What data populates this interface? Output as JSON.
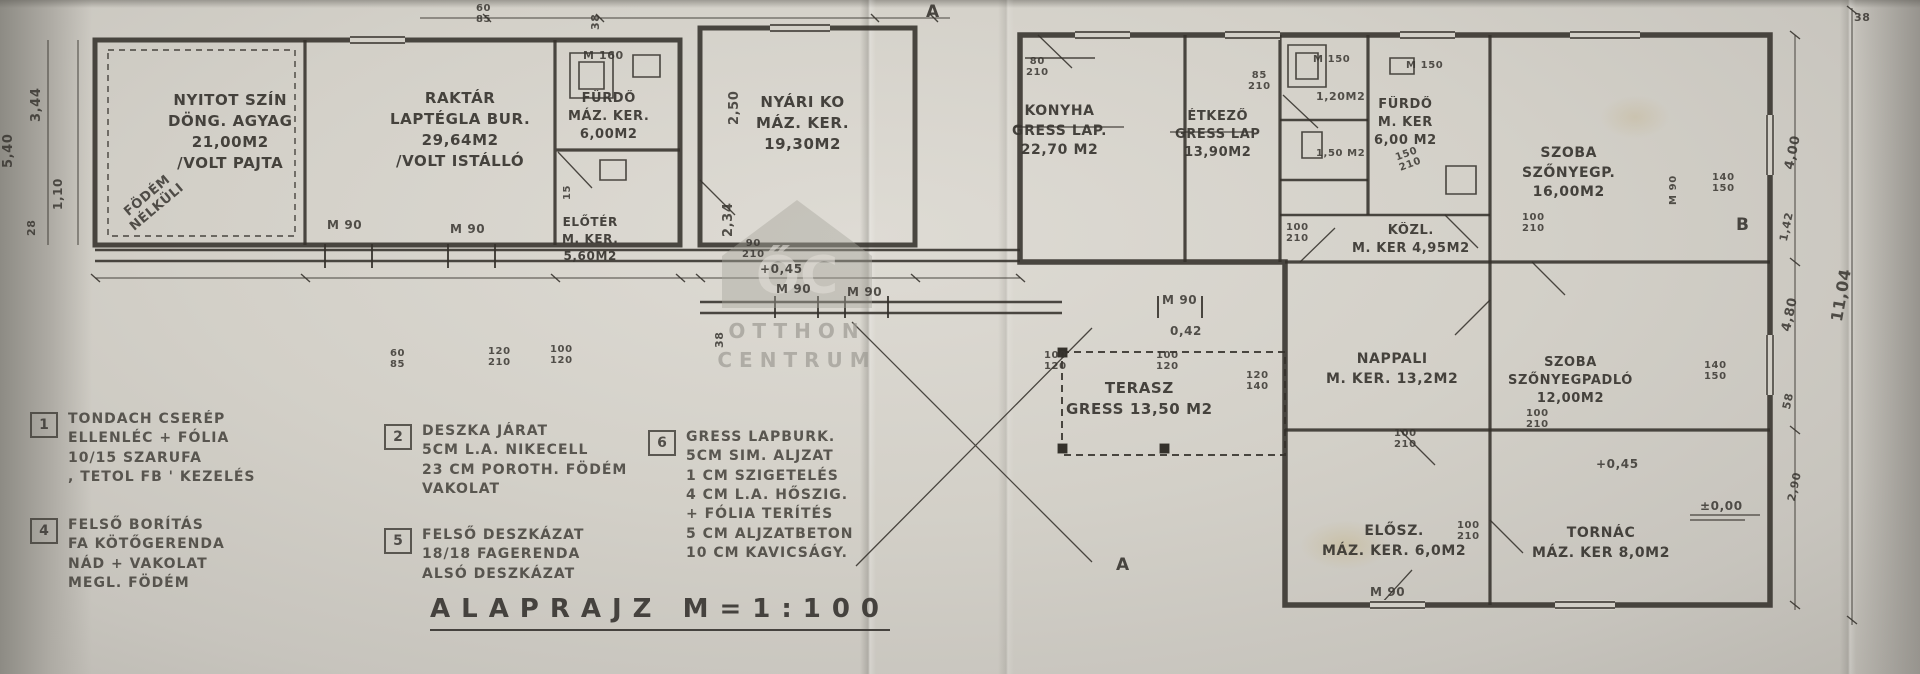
{
  "title": {
    "text": "ALAPRAJZ  M=1:100"
  },
  "watermark": {
    "monogram": "ŐC",
    "name_top": "OTTHON",
    "name_bottom": "CENTRUM"
  },
  "colors": {
    "ink": "#3a3733",
    "paper": "#d3d0c8"
  },
  "plan": {
    "rooms": [
      {
        "text": "NYITOT SZÍN\nDÖNG. AGYAG\n21,00M2\n/VOLT PAJTA",
        "x": 168,
        "y": 90,
        "fs": 15
      },
      {
        "text": "RAKTÁR\nLAPTÉGLA BUR.\n29,64M2\n/VOLT ISTÁLLÓ",
        "x": 390,
        "y": 88,
        "fs": 15
      },
      {
        "text": "FÜRDŐ\nMÁZ. KER.\n6,00M2",
        "x": 568,
        "y": 90,
        "fs": 13
      },
      {
        "text": "ELŐTÉR\nM. KER.\n5,60M2",
        "x": 562,
        "y": 214,
        "fs": 12
      },
      {
        "text": "NYÁRI KO\nMÁZ. KER.\n19,30M2",
        "x": 756,
        "y": 92,
        "fs": 15
      },
      {
        "text": "KONYHA\nGRESS LAP.\n22,70 M2",
        "x": 1012,
        "y": 102,
        "fs": 14
      },
      {
        "text": "ÉTKEZŐ\nGRESS LAP\n13,90M2",
        "x": 1175,
        "y": 108,
        "fs": 13
      },
      {
        "text": "FÜRDŐ\nM. KER\n6,00 M2",
        "x": 1374,
        "y": 96,
        "fs": 13
      },
      {
        "text": "KÖZL.\nM. KER 4,95M2",
        "x": 1352,
        "y": 222,
        "fs": 13
      },
      {
        "text": "SZOBA\nSZŐNYEGP.\n16,00M2",
        "x": 1522,
        "y": 144,
        "fs": 14
      },
      {
        "text": "TERASZ\nGRESS 13,50 M2",
        "x": 1066,
        "y": 378,
        "fs": 15
      },
      {
        "text": "NAPPALI\nM. KER. 13,2M2",
        "x": 1326,
        "y": 350,
        "fs": 14
      },
      {
        "text": "SZOBA\nSZŐNYEGPADLÓ\n12,00M2",
        "x": 1508,
        "y": 354,
        "fs": 13
      },
      {
        "text": "ELŐSZ.\nMÁZ. KER. 6,0M2",
        "x": 1322,
        "y": 522,
        "fs": 14
      },
      {
        "text": "TORNÁC\nMÁZ. KER 8,0M2",
        "x": 1532,
        "y": 524,
        "fs": 14
      }
    ],
    "dimensions": [
      {
        "text": "M 160",
        "x": 583,
        "y": 50,
        "fs": 11
      },
      {
        "text": "M 90",
        "x": 327,
        "y": 219,
        "fs": 12
      },
      {
        "text": "M 90",
        "x": 450,
        "y": 223,
        "fs": 12
      },
      {
        "text": "90\n210",
        "x": 742,
        "y": 238,
        "fs": 10
      },
      {
        "text": "+0,45",
        "x": 760,
        "y": 263,
        "fs": 12
      },
      {
        "text": "M 90",
        "x": 776,
        "y": 283,
        "fs": 12
      },
      {
        "text": "M 90",
        "x": 847,
        "y": 286,
        "fs": 12
      },
      {
        "text": "M 90",
        "x": 1162,
        "y": 294,
        "fs": 12
      },
      {
        "text": "0,42",
        "x": 1170,
        "y": 325,
        "fs": 12
      },
      {
        "text": "2,50",
        "x": 728,
        "y": 125,
        "fs": 13,
        "rot": -90
      },
      {
        "text": "2,34",
        "x": 722,
        "y": 237,
        "fs": 13,
        "rot": -90
      },
      {
        "text": "38",
        "x": 590,
        "y": 30,
        "fs": 11,
        "rot": -90
      },
      {
        "text": "38",
        "x": 714,
        "y": 348,
        "fs": 11,
        "rot": -90
      },
      {
        "text": "15",
        "x": 562,
        "y": 200,
        "fs": 10,
        "rot": -90
      },
      {
        "text": "60\n85",
        "x": 476,
        "y": 3,
        "fs": 10
      },
      {
        "text": "60\n85",
        "x": 390,
        "y": 348,
        "fs": 10
      },
      {
        "text": "120\n210",
        "x": 488,
        "y": 346,
        "fs": 10
      },
      {
        "text": "100\n120",
        "x": 550,
        "y": 344,
        "fs": 10
      },
      {
        "text": "100\n120",
        "x": 1044,
        "y": 350,
        "fs": 10
      },
      {
        "text": "100\n120",
        "x": 1156,
        "y": 350,
        "fs": 10
      },
      {
        "text": "120\n140",
        "x": 1246,
        "y": 370,
        "fs": 10
      },
      {
        "text": "80\n210",
        "x": 1026,
        "y": 56,
        "fs": 10
      },
      {
        "text": "85\n210",
        "x": 1248,
        "y": 70,
        "fs": 10
      },
      {
        "text": "M 150",
        "x": 1313,
        "y": 54,
        "fs": 10
      },
      {
        "text": "M 150",
        "x": 1406,
        "y": 60,
        "fs": 10
      },
      {
        "text": "1,20M2",
        "x": 1316,
        "y": 91,
        "fs": 11
      },
      {
        "text": "1,50 M2",
        "x": 1316,
        "y": 148,
        "fs": 10
      },
      {
        "text": "150\n210",
        "x": 1394,
        "y": 153,
        "fs": 10,
        "rot": -20
      },
      {
        "text": "100\n210",
        "x": 1286,
        "y": 222,
        "fs": 10
      },
      {
        "text": "100\n210",
        "x": 1522,
        "y": 212,
        "fs": 10
      },
      {
        "text": "100\n210",
        "x": 1526,
        "y": 408,
        "fs": 10
      },
      {
        "text": "100\n210",
        "x": 1394,
        "y": 428,
        "fs": 10
      },
      {
        "text": "100\n210",
        "x": 1457,
        "y": 520,
        "fs": 10
      },
      {
        "text": "140\n150",
        "x": 1712,
        "y": 172,
        "fs": 10
      },
      {
        "text": "140\n150",
        "x": 1704,
        "y": 360,
        "fs": 10
      },
      {
        "text": "M 90",
        "x": 1668,
        "y": 205,
        "fs": 10,
        "rot": -90
      },
      {
        "text": "M 90",
        "x": 1370,
        "y": 586,
        "fs": 12
      },
      {
        "text": "+0,45",
        "x": 1596,
        "y": 458,
        "fs": 12
      },
      {
        "text": "±0,00",
        "x": 1700,
        "y": 500,
        "fs": 12
      },
      {
        "text": "4,00",
        "x": 1783,
        "y": 168,
        "fs": 13,
        "rot": -78
      },
      {
        "text": "1,42",
        "x": 1778,
        "y": 240,
        "fs": 11,
        "rot": -78
      },
      {
        "text": "11,04",
        "x": 1828,
        "y": 320,
        "fs": 16,
        "rot": -80
      },
      {
        "text": "4,80",
        "x": 1780,
        "y": 330,
        "fs": 13,
        "rot": -78
      },
      {
        "text": "58",
        "x": 1781,
        "y": 408,
        "fs": 11,
        "rot": -78
      },
      {
        "text": "2,90",
        "x": 1786,
        "y": 500,
        "fs": 11,
        "rot": -78
      },
      {
        "text": "38",
        "x": 1854,
        "y": 12,
        "fs": 11
      },
      {
        "text": "5,40",
        "x": 2,
        "y": 168,
        "fs": 13,
        "rot": -90
      },
      {
        "text": "3,44",
        "x": 30,
        "y": 122,
        "fs": 13,
        "rot": -90
      },
      {
        "text": "1,10",
        "x": 52,
        "y": 210,
        "fs": 12,
        "rot": -90
      },
      {
        "text": "28",
        "x": 26,
        "y": 236,
        "fs": 11,
        "rot": -90
      },
      {
        "text": "FÖDÉM\nNÉLKÜLI",
        "x": 118,
        "y": 212,
        "fs": 13,
        "rot": -40
      }
    ],
    "markers": [
      {
        "text": "A",
        "x": 926,
        "y": 1
      },
      {
        "text": "A",
        "x": 1116,
        "y": 554
      },
      {
        "text": "B",
        "x": 1736,
        "y": 214
      }
    ]
  },
  "legend": {
    "items": [
      {
        "num": "1",
        "x": 30,
        "y": 410,
        "text": "TONDACH CSERÉP\nELLENLÉC + FÓLIA\n10/15 SZARUFA\n, TETOL FB ' KEZELÉS"
      },
      {
        "num": "4",
        "x": 30,
        "y": 516,
        "text": "FELSŐ BORÍTÁS\nFA KÖTŐGERENDA\nNÁD + VAKOLAT\nMEGL. FÖDÉM"
      },
      {
        "num": "2",
        "x": 384,
        "y": 422,
        "text": "DESZKA JÁRAT\n5CM L.A. NIKECELL\n23 CM POROTH. FÖDÉM\nVAKOLAT"
      },
      {
        "num": "5",
        "x": 384,
        "y": 526,
        "text": "FELSŐ DESZKÁZAT\n18/18 FAGERENDA\nALSÓ DESZKÁZAT"
      },
      {
        "num": "6",
        "x": 648,
        "y": 428,
        "text": "GRESS LAPBURK.\n5CM SIM. ALJZAT\n1 CM SZIGETELÉS\n4 CM L.A. HŐSZIG.\n+ FÓLIA TERÍTÉS\n5 CM ALJZATBETON\n10 CM KAVICSÁGY."
      }
    ]
  }
}
